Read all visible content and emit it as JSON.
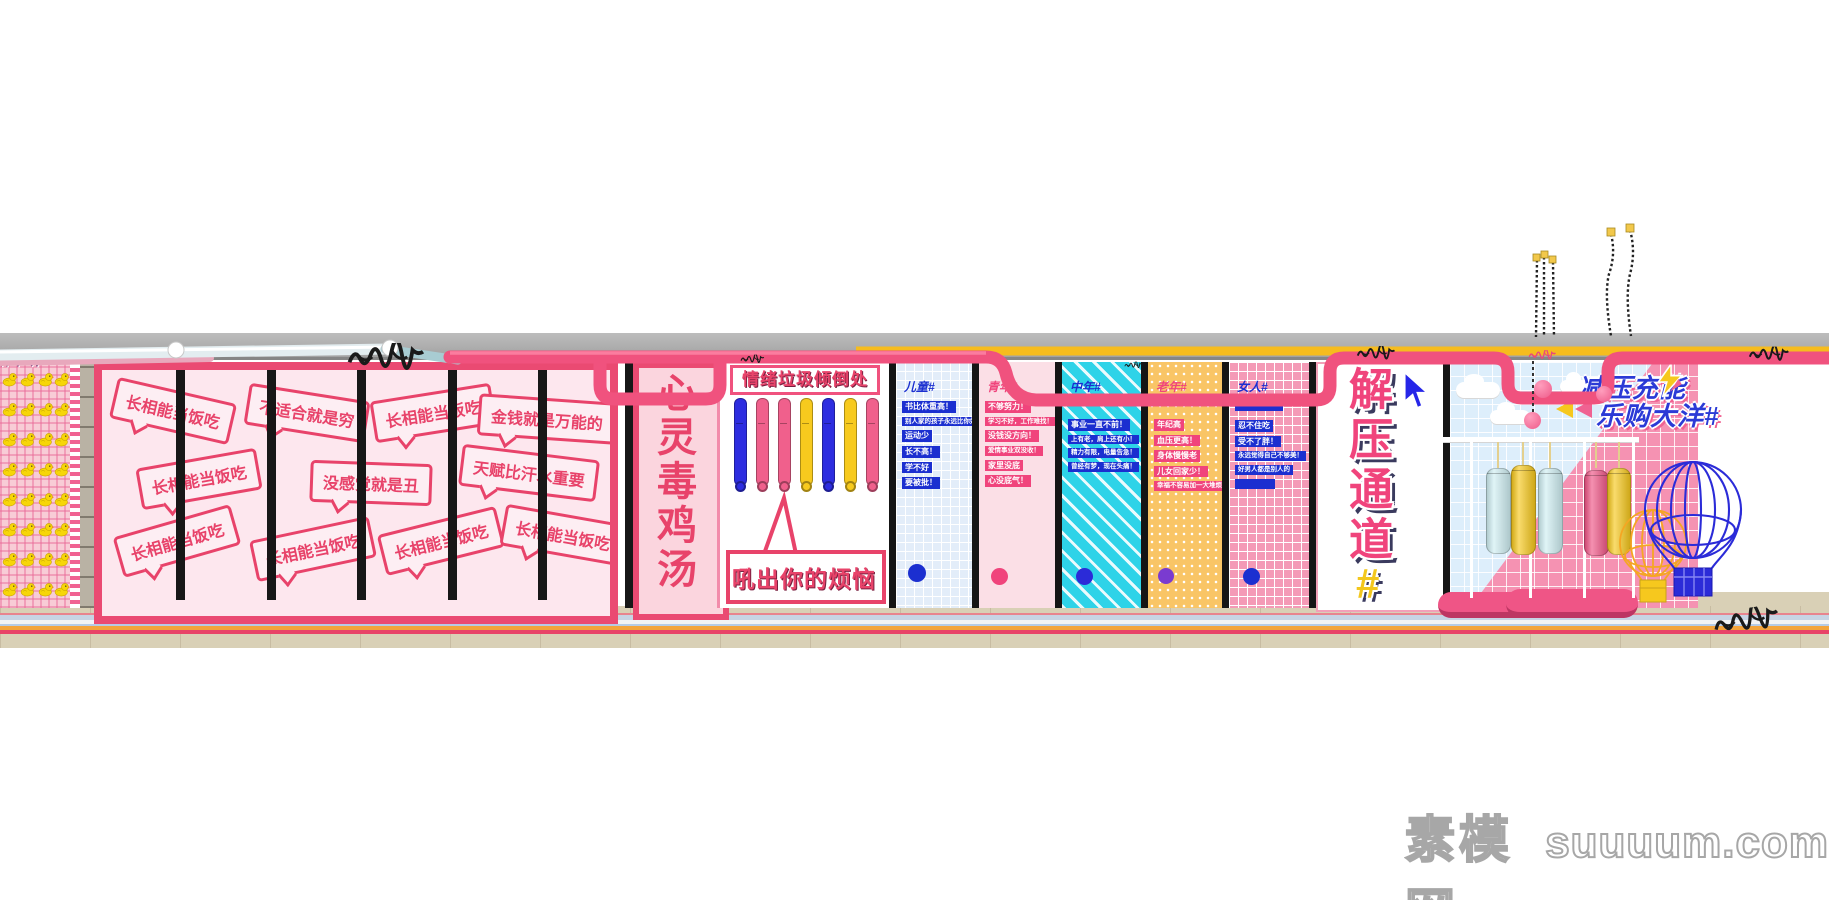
{
  "graffiti": {
    "left_text": "听不听"
  },
  "bubble_wall": {
    "bubbles": [
      "长相能当饭吃",
      "不适合就是穷",
      "长相能当饭吃",
      "金钱就是万能的",
      "长相能当饭吃",
      "没感觉就是丑",
      "天赋比汗水重要",
      "长相能当饭吃",
      "长相能当饭吃",
      "长相能当饭吃",
      "长相能当饭吃"
    ]
  },
  "soup_panel": {
    "title": "心灵毒鸡汤"
  },
  "emotion_panel": {
    "title": "情绪垃圾倾倒处",
    "shout": "吼出你的烦恼",
    "bat_colors": [
      "#2d2de0",
      "#f0608c",
      "#f0608c",
      "#f7ca1e",
      "#2d2de0",
      "#f7ca1e",
      "#f0608c"
    ]
  },
  "hashtag_panels": {
    "kids": {
      "header": "儿童#",
      "dot_color": "#1b2fd0",
      "lines": [
        "书比体重高！",
        "别人家的孩子永远比你好！",
        "运动少",
        "长不高！",
        "学不好",
        "要被批！"
      ]
    },
    "youth": {
      "header": "青年#",
      "dot_color": "#f0447c",
      "lines": [
        "不够努力！",
        "学习不好，工作难找！",
        "没钱没方向！",
        "爱情事业双没收！",
        "家里没底",
        "心没底气！"
      ]
    },
    "midlife": {
      "header": "中年#",
      "dot_color": "#2b2bd8",
      "lines": [
        "事业一直不前！",
        "上有老，肩上还有小！",
        "精力有限，电量告急！",
        "曾经有梦，现在头痛！"
      ]
    },
    "senior": {
      "header": "老年#",
      "dot_color": "#7a3bd0",
      "lines": [
        "年纪高",
        "血压更高！",
        "身体慢慢老",
        "儿女回家少！",
        "幸福不容易加一大堆烦恼！"
      ]
    },
    "women": {
      "header": "女人#",
      "dot_color": "#1b2fd0",
      "lines": [
        "忍不住吃",
        "受不了胖！",
        "永远觉得自己不够美！",
        "好男人都是别人的"
      ]
    }
  },
  "channel_panel": {
    "title": "解压通道",
    "hash": "#"
  },
  "recharge_zone": {
    "line1": "减压充能",
    "line2": "乐购大洋#",
    "cylinder_colors": [
      "#cfeef2",
      "#f6c81e",
      "#cfeef2",
      "#ef5586",
      "#f6c81e"
    ]
  },
  "watermark": {
    "cn": "素模网",
    "en": "suuuum.com"
  },
  "colors": {
    "accent_pink": "#e8436a",
    "pipe_pink": "#f0527e",
    "pipe_yellow": "#f6bc1e",
    "pipe_silver": "#e3edf0",
    "tag_blue": "#1b2fd0",
    "tag_pink": "#f0447c",
    "floor_stripes": [
      "#e8848e",
      "#c7d4e4",
      "#f2f3f5",
      "#b6cbe6",
      "#f3a43c",
      "#e84368"
    ]
  }
}
